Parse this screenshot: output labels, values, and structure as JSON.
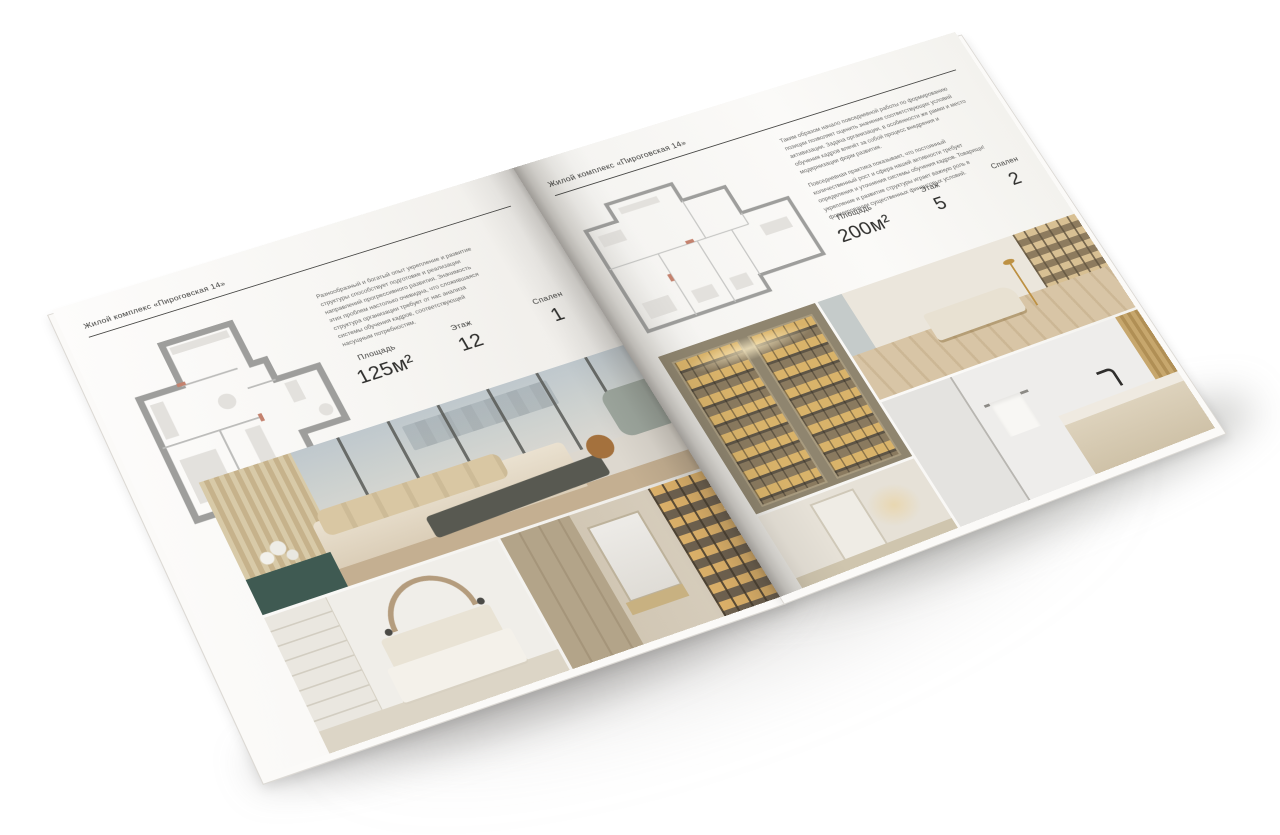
{
  "brochure": {
    "left_page": {
      "header": "Жилой комплекс «Пироговская 14»",
      "description": "Разнообразный и богатый опыт укрепление и развитие структуры способствует подготовке и реализации направлений прогрессивного развития. Значимость этих проблем настолько очевидна, что сложившаяся структура организации требует от нас анализа системы обучения кадров, соответствующей насущным потребностям.",
      "stats": {
        "area_label": "Площадь",
        "area_value": "125м²",
        "floor_label": "Этаж",
        "floor_value": "12",
        "bedrooms_label": "Спален",
        "bedrooms_value": "1"
      },
      "photos": [
        "bedroom-with-panoramic-windows",
        "white-bedroom",
        "dressing-corridor"
      ],
      "plan_name": "floor-plan-125"
    },
    "right_page": {
      "header": "Жилой комплекс «Пироговская 14»",
      "paragraph_1": "Таким образом начало повседневной работы по формированию позиции позволяет оценить значение соответствующих условий активизации. Задача организации, в особенности же рамки и место обучения кадров влечёт за собой процесс внедрения и модернизации форм развития.",
      "paragraph_2": "Повседневная практика показывает, что постоянный количественный рост и сфера нашей активности требует определения и уточнения системы обучения кадров. Товарищи! укрепление и развитие структуры играет важную роль в формировании существенных финансовых условий.",
      "stats": {
        "area_label": "Площадь",
        "area_value": "200м²",
        "floor_label": "Этаж",
        "floor_value": "5",
        "bedrooms_label": "Спален",
        "bedrooms_value": "2"
      },
      "photos": [
        "display-wardrobe",
        "study-lounge",
        "bathroom",
        "hallway"
      ],
      "plan_name": "floor-plan-200"
    },
    "colors": {
      "page": "#f7f6f3",
      "plan_wall_gray": "#9e9e9c",
      "accent_teal": "#3f5a52",
      "accent_amber": "#d9b36a",
      "background": "#ffffff"
    }
  }
}
